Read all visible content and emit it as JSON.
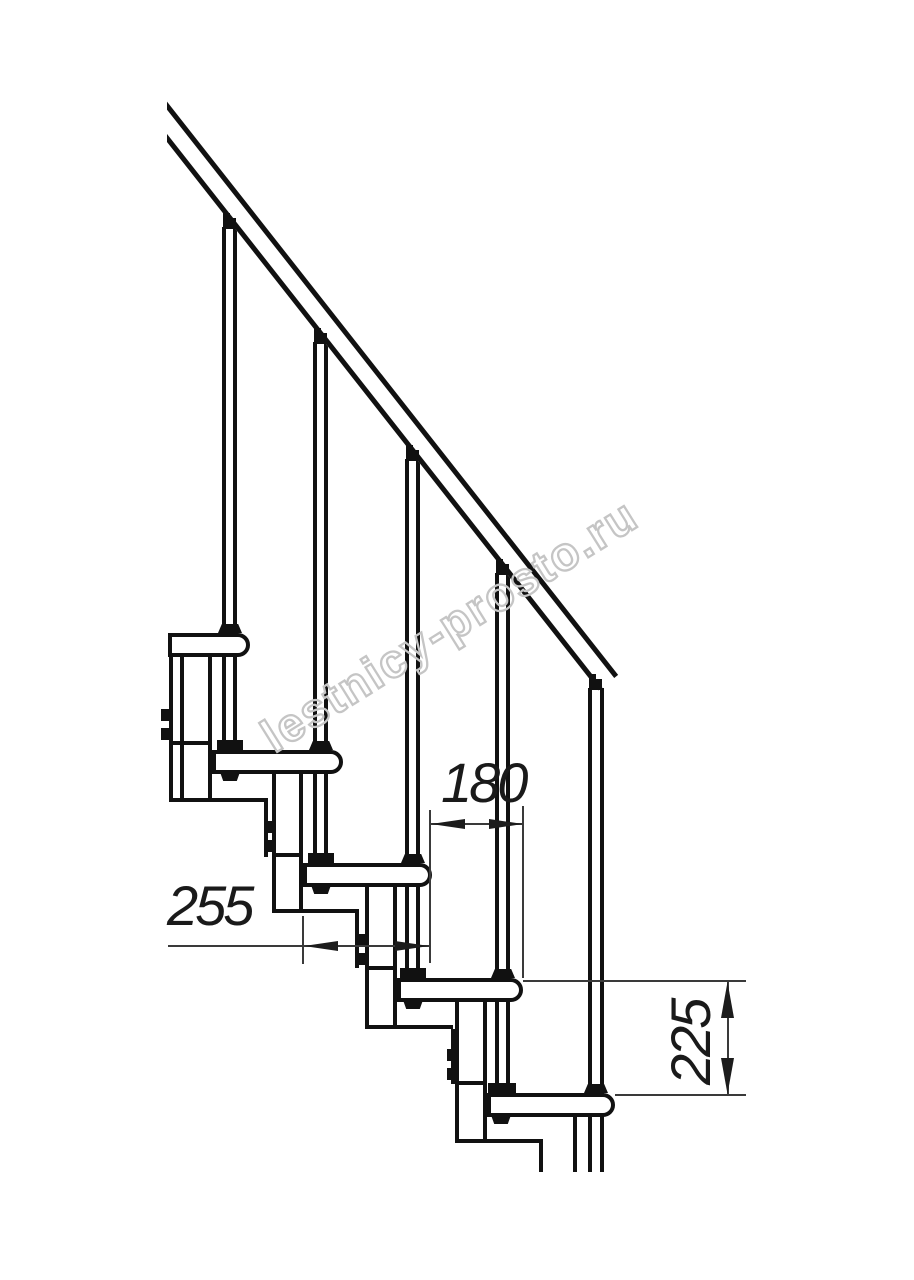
{
  "meta": {
    "width": 914,
    "height": 1280,
    "background_color": "#ffffff",
    "line_color": "#111111",
    "dimension_color": "#1a1a1a",
    "watermark_color": "#c5c5c5",
    "description": "Side-elevation technical drawing of a modular staircase with handrail, balusters, five treads and support columns"
  },
  "watermark": {
    "text": "lestnicy-prosto.ru"
  },
  "dimensions": {
    "run_label": "180",
    "depth_label": "255",
    "rise_label": "225"
  },
  "drawing": {
    "shapes": [
      {
        "c": "rail",
        "n": "handrail",
        "x": 150,
        "y": 80,
        "w": 757,
        "h": 25,
        "r": 51.8
      },
      {
        "c": "bal",
        "n": "baluster-1",
        "x": 222,
        "y": 227,
        "w": 15,
        "h": 515
      },
      {
        "c": "bal",
        "n": "baluster-2",
        "x": 313,
        "y": 342,
        "w": 15,
        "h": 514
      },
      {
        "c": "bal",
        "n": "baluster-3",
        "x": 405,
        "y": 459,
        "w": 15,
        "h": 512
      },
      {
        "c": "bal",
        "n": "baluster-4",
        "x": 495,
        "y": 573,
        "w": 15,
        "h": 513
      },
      {
        "c": "bal",
        "n": "baluster-5",
        "x": 588,
        "y": 688,
        "w": 16,
        "h": 484
      },
      {
        "c": "col",
        "n": "support-column-1",
        "x": 169,
        "y": 653,
        "w": 43,
        "h": 149
      },
      {
        "c": "vline",
        "n": "column-detail-line",
        "x": 180,
        "y": 655,
        "w": 4,
        "h": 145
      },
      {
        "c": "hline",
        "n": "column-detail-line",
        "x": 172,
        "y": 741,
        "w": 38,
        "h": 4
      },
      {
        "c": "tab",
        "n": "mounting-bracket",
        "x": 161,
        "y": 709,
        "w": 10,
        "h": 12
      },
      {
        "c": "tab",
        "n": "mounting-bracket",
        "x": 161,
        "y": 728,
        "w": 10,
        "h": 12
      },
      {
        "c": "hline",
        "n": "column-base-line",
        "x": 212,
        "y": 798,
        "w": 56,
        "h": 4
      },
      {
        "c": "vline",
        "n": "column-base-line",
        "x": 264,
        "y": 802,
        "w": 4,
        "h": 55
      },
      {
        "c": "col",
        "n": "support-column-2",
        "x": 272,
        "y": 770,
        "w": 31,
        "h": 143
      },
      {
        "c": "hline",
        "n": "column-detail-line",
        "x": 275,
        "y": 853,
        "w": 25,
        "h": 4
      },
      {
        "c": "tab",
        "n": "mounting-bracket",
        "x": 264,
        "y": 821,
        "w": 10,
        "h": 12
      },
      {
        "c": "tab",
        "n": "mounting-bracket",
        "x": 264,
        "y": 840,
        "w": 10,
        "h": 12
      },
      {
        "c": "hline",
        "n": "column-base-line",
        "x": 303,
        "y": 909,
        "w": 56,
        "h": 4
      },
      {
        "c": "vline",
        "n": "column-base-line",
        "x": 355,
        "y": 913,
        "w": 4,
        "h": 55
      },
      {
        "c": "col",
        "n": "support-column-3",
        "x": 365,
        "y": 883,
        "w": 32,
        "h": 146
      },
      {
        "c": "hline",
        "n": "column-detail-line",
        "x": 368,
        "y": 966,
        "w": 26,
        "h": 4
      },
      {
        "c": "tab",
        "n": "mounting-bracket",
        "x": 357,
        "y": 934,
        "w": 10,
        "h": 12
      },
      {
        "c": "tab",
        "n": "mounting-bracket",
        "x": 357,
        "y": 953,
        "w": 10,
        "h": 12
      },
      {
        "c": "hline",
        "n": "column-base-line",
        "x": 397,
        "y": 1025,
        "w": 56,
        "h": 4
      },
      {
        "c": "vline",
        "n": "column-base-line",
        "x": 451,
        "y": 1029,
        "w": 4,
        "h": 55
      },
      {
        "c": "col",
        "n": "support-column-4",
        "x": 455,
        "y": 998,
        "w": 32,
        "h": 145
      },
      {
        "c": "hline",
        "n": "column-detail-line",
        "x": 458,
        "y": 1081,
        "w": 26,
        "h": 4
      },
      {
        "c": "tab",
        "n": "mounting-bracket",
        "x": 447,
        "y": 1049,
        "w": 10,
        "h": 12
      },
      {
        "c": "tab",
        "n": "mounting-bracket",
        "x": 447,
        "y": 1068,
        "w": 10,
        "h": 12
      },
      {
        "c": "hline",
        "n": "column-base-line",
        "x": 487,
        "y": 1139,
        "w": 56,
        "h": 4
      },
      {
        "c": "vline",
        "n": "column-base-line",
        "x": 539,
        "y": 1143,
        "w": 4,
        "h": 29
      },
      {
        "c": "vline",
        "n": "column-base-line",
        "x": 573,
        "y": 1115,
        "w": 4,
        "h": 57
      },
      {
        "c": "tread",
        "n": "stair-tread-1",
        "x": 168,
        "y": 633,
        "w": 82,
        "h": 24
      },
      {
        "c": "tread",
        "n": "stair-tread-2",
        "x": 212,
        "y": 750,
        "w": 131,
        "h": 24
      },
      {
        "c": "tread",
        "n": "stair-tread-3",
        "x": 303,
        "y": 863,
        "w": 129,
        "h": 24
      },
      {
        "c": "tread",
        "n": "stair-tread-4",
        "x": 397,
        "y": 978,
        "w": 126,
        "h": 24
      },
      {
        "c": "tread",
        "n": "stair-tread-5",
        "x": 487,
        "y": 1093,
        "w": 128,
        "h": 24
      },
      {
        "c": "trapd",
        "n": "baluster-collar",
        "x": 218,
        "y": 624,
        "w": 24,
        "h": 9
      },
      {
        "c": "trapd",
        "n": "baluster-collar",
        "x": 309,
        "y": 741,
        "w": 24,
        "h": 9
      },
      {
        "c": "trapd",
        "n": "baluster-collar",
        "x": 401,
        "y": 854,
        "w": 24,
        "h": 9
      },
      {
        "c": "trapd",
        "n": "baluster-collar",
        "x": 491,
        "y": 969,
        "w": 24,
        "h": 9
      },
      {
        "c": "trapd",
        "n": "baluster-collar",
        "x": 584,
        "y": 1084,
        "w": 24,
        "h": 9
      },
      {
        "c": "blk",
        "n": "baluster-base-connector",
        "x": 217,
        "y": 740,
        "w": 26,
        "h": 10
      },
      {
        "c": "blk",
        "n": "baluster-base-connector",
        "x": 308,
        "y": 853,
        "w": 26,
        "h": 10
      },
      {
        "c": "blk",
        "n": "baluster-base-connector",
        "x": 400,
        "y": 968,
        "w": 26,
        "h": 10
      },
      {
        "c": "blk",
        "n": "baluster-base-connector",
        "x": 488,
        "y": 1083,
        "w": 28,
        "h": 10
      },
      {
        "c": "trapu",
        "n": "tread-bolt-nut",
        "x": 220,
        "y": 772,
        "w": 20,
        "h": 9
      },
      {
        "c": "trapu",
        "n": "tread-bolt-nut",
        "x": 311,
        "y": 885,
        "w": 20,
        "h": 9
      },
      {
        "c": "trapu",
        "n": "tread-bolt-nut",
        "x": 403,
        "y": 1000,
        "w": 20,
        "h": 9
      },
      {
        "c": "trapu",
        "n": "tread-bolt-nut",
        "x": 491,
        "y": 1115,
        "w": 20,
        "h": 9
      },
      {
        "c": "blk",
        "n": "rail-connector",
        "x": 223,
        "y": 218,
        "w": 13,
        "h": 11
      },
      {
        "c": "blk",
        "n": "rail-connector-step",
        "x": 223,
        "y": 213,
        "w": 7,
        "h": 5
      },
      {
        "c": "blk",
        "n": "rail-connector",
        "x": 314,
        "y": 333,
        "w": 13,
        "h": 11
      },
      {
        "c": "blk",
        "n": "rail-connector-step",
        "x": 314,
        "y": 328,
        "w": 7,
        "h": 5
      },
      {
        "c": "blk",
        "n": "rail-connector",
        "x": 406,
        "y": 450,
        "w": 13,
        "h": 11
      },
      {
        "c": "blk",
        "n": "rail-connector-step",
        "x": 406,
        "y": 445,
        "w": 7,
        "h": 5
      },
      {
        "c": "blk",
        "n": "rail-connector",
        "x": 496,
        "y": 564,
        "w": 13,
        "h": 11
      },
      {
        "c": "blk",
        "n": "rail-connector-step",
        "x": 496,
        "y": 559,
        "w": 7,
        "h": 5
      },
      {
        "c": "blk",
        "n": "rail-connector",
        "x": 589,
        "y": 679,
        "w": 13,
        "h": 11
      },
      {
        "c": "blk",
        "n": "rail-connector-step",
        "x": 589,
        "y": 674,
        "w": 7,
        "h": 5
      },
      {
        "c": "cover",
        "n": "crop-cover",
        "x": 0,
        "y": 0,
        "w": 167,
        "h": 620
      },
      {
        "c": "dline",
        "n": "extension-line",
        "x": 429,
        "y": 810,
        "w": 2,
        "h": 153
      },
      {
        "c": "dline",
        "n": "extension-line",
        "x": 522,
        "y": 806,
        "w": 2,
        "h": 172
      },
      {
        "c": "dline",
        "n": "extension-line",
        "x": 302,
        "y": 916,
        "w": 2,
        "h": 48
      },
      {
        "c": "dline",
        "n": "dimension-line-180",
        "x": 430,
        "y": 823,
        "w": 93,
        "h": 2
      },
      {
        "c": "dline",
        "n": "dimension-line-255",
        "x": 168,
        "y": 945,
        "w": 262,
        "h": 2
      },
      {
        "c": "dline",
        "n": "extension-line",
        "x": 523,
        "y": 980,
        "w": 223,
        "h": 2
      },
      {
        "c": "dline",
        "n": "extension-line",
        "x": 615,
        "y": 1094,
        "w": 131,
        "h": 2
      },
      {
        "c": "dline",
        "n": "dimension-line-225",
        "x": 727,
        "y": 980,
        "w": 2,
        "h": 116
      },
      {
        "c": "arw-l",
        "n": "dimension-arrow",
        "x": 431,
        "y": 819,
        "w": 34,
        "h": 10
      },
      {
        "c": "arw-r",
        "n": "dimension-arrow",
        "x": 489,
        "y": 819,
        "w": 34,
        "h": 10
      },
      {
        "c": "arw-l",
        "n": "dimension-arrow",
        "x": 304,
        "y": 941,
        "w": 34,
        "h": 10
      },
      {
        "c": "arw-r",
        "n": "dimension-arrow",
        "x": 395,
        "y": 941,
        "w": 34,
        "h": 10
      },
      {
        "c": "arw-u",
        "n": "dimension-arrow",
        "x": 721,
        "y": 982,
        "w": 13,
        "h": 36
      },
      {
        "c": "arw-d",
        "n": "dimension-arrow",
        "x": 721,
        "y": 1058,
        "w": 13,
        "h": 36
      }
    ]
  }
}
